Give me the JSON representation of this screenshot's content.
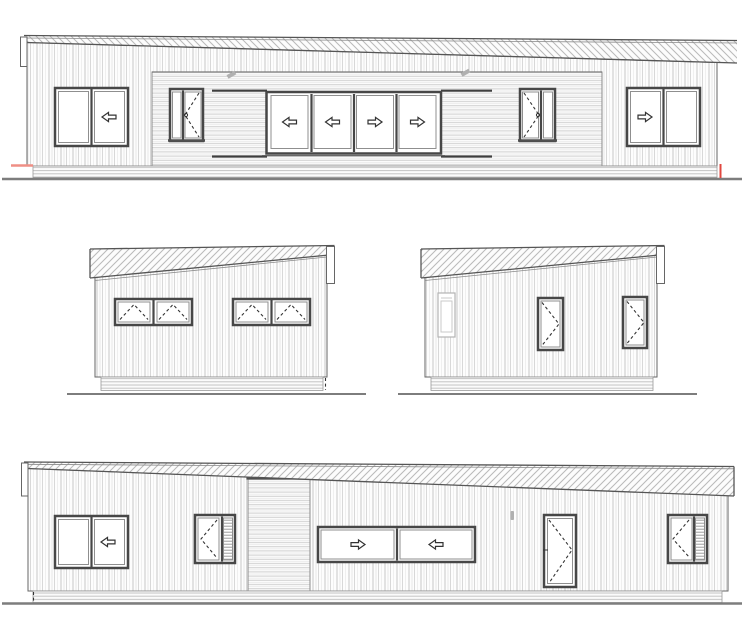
{
  "sheet": {
    "kind": "architectural elevation line drawings",
    "drawing_count": 4,
    "visible_text": "none"
  },
  "colors": {
    "background": "#ffffff",
    "line": "#666666",
    "frame": "#474747",
    "sash": "#8f8f8f",
    "symbol": "#333333",
    "ground": "#7d7d7d",
    "hatch": "#b9b9b9",
    "siding": "#cccccc",
    "datum_left": "#ef8f85",
    "datum_right": "#e0473f"
  },
  "elevations": [
    {
      "id": "top-long-elevation",
      "position": "top",
      "roof": "mono-pitch with hatched fascia, thin at left and deepening to the right",
      "cladding": "vertical boards with recessed horizontal-board centre section",
      "openings": {
        "sliding_windows": 2,
        "hinged_doors_with_sidelight": 2,
        "sliding_door_panels": 4
      },
      "arrow_icons": [
        "left",
        "left",
        "left",
        "right",
        "right",
        "right"
      ],
      "datum_marks": [
        "red horizontal tick at lower left",
        "red vertical tick at lower right"
      ]
    },
    {
      "id": "middle-left-elevation",
      "position": "middle-left",
      "roof": "mono-pitch fascia, deep at left tapering right, with right fascia return",
      "cladding": "vertical boards",
      "openings": {
        "awning_window_pairs": 2
      }
    },
    {
      "id": "middle-right-elevation",
      "position": "middle-right",
      "roof": "mono-pitch fascia, deep at left tapering right, with right fascia return",
      "cladding": "vertical boards",
      "openings": {
        "tall_casement_windows": 2,
        "flue_panel": 1
      }
    },
    {
      "id": "bottom-long-elevation",
      "position": "bottom",
      "roof": "mono-pitch with hatched fascia, thin at left and deepening to the right",
      "cladding": "vertical boards with recessed horizontal-board entry strip",
      "openings": {
        "sliding_windows": 2,
        "casement_louvre_windows": 2,
        "hinged_doors": 1
      },
      "arrow_icons": [
        "left",
        "right",
        "left"
      ]
    }
  ]
}
